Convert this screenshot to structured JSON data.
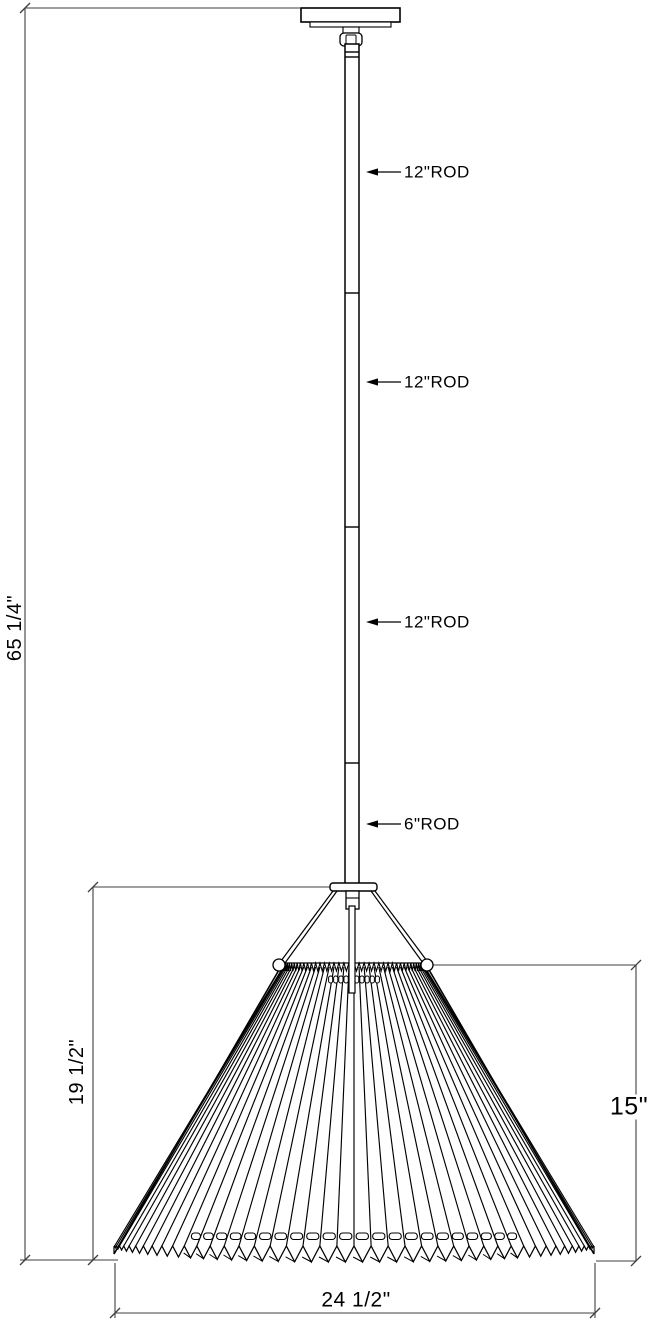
{
  "drawing": {
    "title": "pendant-light-dimension-drawing",
    "labels": {
      "rod_segments": [
        {
          "text": "12\"ROD"
        },
        {
          "text": "12\"ROD"
        },
        {
          "text": "12\"ROD"
        },
        {
          "text": "6\"ROD"
        }
      ],
      "overall_height": "65 1/4\"",
      "shade_assembly_height": "19 1/2\"",
      "shade_height": "15\"",
      "shade_width": "24 1/2\""
    },
    "colors": {
      "object_line": "#000000",
      "dimension_line": "#3f3f3f",
      "background": "#ffffff",
      "text": "#000000"
    }
  }
}
